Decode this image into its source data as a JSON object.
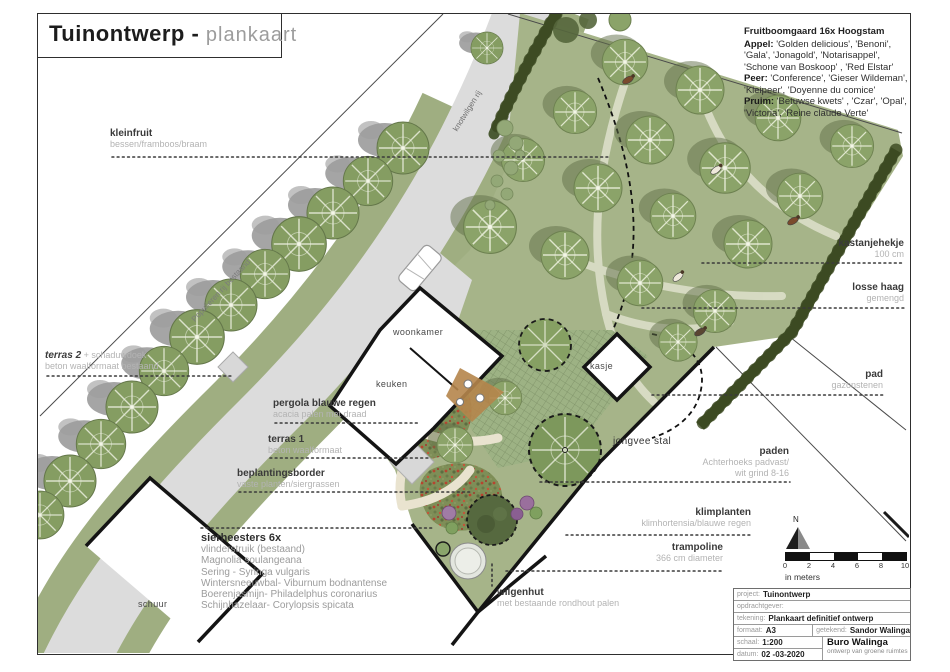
{
  "palette": {
    "orchard_green": "#a6b489",
    "hedge_green": "#49582f",
    "road_gray": "#dcdcdc",
    "meadow_base": "#7e8e57"
  },
  "title": {
    "main": "Tuinontwerp -",
    "sub": "plankaart"
  },
  "orchard_note": {
    "title": "Fruitboomgaard 16x Hoogstam",
    "appel_label": "Appel:",
    "appel_text": " 'Golden delicious', 'Benoni', 'Gala', 'Jonagold', 'Notarisappel', 'Schone van Boskoop' , 'Red Elstar'",
    "peer_label": "Peer:",
    "peer_text": " 'Conference', 'Gieser Wildeman', 'Kleipeer', 'Doyenne du comice'",
    "pruim_label": "Pruim:",
    "pruim_text": " 'Betuwse kwets' , 'Czar', 'Opal', 'Victoria', 'Reine claude Verte'"
  },
  "labels": {
    "kleinfruit": {
      "title": "kleinfruit",
      "sub": "bessen/framboos/braam"
    },
    "terras2": {
      "title": "terras 2",
      "suffix": " + schaduwdoek",
      "sub": "beton waalformaat bestaand"
    },
    "pergola": {
      "title": "pergola blauwe regen",
      "sub": "acacia palen met draad"
    },
    "terras1": {
      "title": "terras 1",
      "sub": "beton waalformaat"
    },
    "beplantingsborder": {
      "title": "beplantingsborder",
      "sub": "vaste planten/siergrassen"
    },
    "sierheesters": {
      "title": "sierheesters 6x",
      "items": [
        "vlinderstruik (bestaand)",
        "Magnolia soulangeana",
        "Sering - Syringa vulgaris",
        "Wintersneeuwbal- Viburnum bodnantense",
        "Boerenjasmijn- Philadelphus coronarius",
        "Schijnhazelaar- Corylopsis spicata"
      ]
    },
    "wilgenhut": {
      "title": "wilgenhut",
      "sub": "met bestaande rondhout palen"
    },
    "trampoline": {
      "title": "trampoline",
      "sub": "366 cm diameter"
    },
    "klimplanten": {
      "title": "klimplanten",
      "sub": "klimhortensia/blauwe regen"
    },
    "paden": {
      "title": "paden",
      "sub1": "Achterhoeks padvast/",
      "sub2": "wit grind 8-16"
    },
    "pad": {
      "title": "pad",
      "sub": "gazonstenen"
    },
    "losse_haag": {
      "title": "losse haag",
      "sub": "gemengd"
    },
    "kastanjehekje": {
      "title": "kastanjehekje",
      "sub": "100 cm"
    },
    "knotwilgen": "knotwilgen rij",
    "populieren": "Populieren rij bestaand"
  },
  "buildings": {
    "woonkamer": "woonkamer",
    "keuken": "keuken",
    "kasje": "kasje",
    "jongvee_stal": "jongvee stal",
    "schuur": "schuur"
  },
  "compass": {
    "north": "N"
  },
  "scalebar": {
    "ticks": [
      "0",
      "2",
      "4",
      "6",
      "8",
      "10"
    ],
    "unit": "in meters"
  },
  "titleblock": {
    "project_label": "project:",
    "project": "Tuinontwerp",
    "client_label": "opdrachtgever:",
    "client": "",
    "drawing_label": "tekening:",
    "drawing": "Plankaart definitief ontwerp",
    "format_label": "formaat:",
    "format": "A3",
    "drawn_label": "getekend:",
    "drawn": "Sandor Walinga",
    "scale_label": "schaal:",
    "scale": "1:200",
    "date_label": "datum:",
    "date": "02 -03-2020",
    "firm": "Buro Walinga",
    "firm_sub": "ontwerp van groene ruimtes"
  }
}
